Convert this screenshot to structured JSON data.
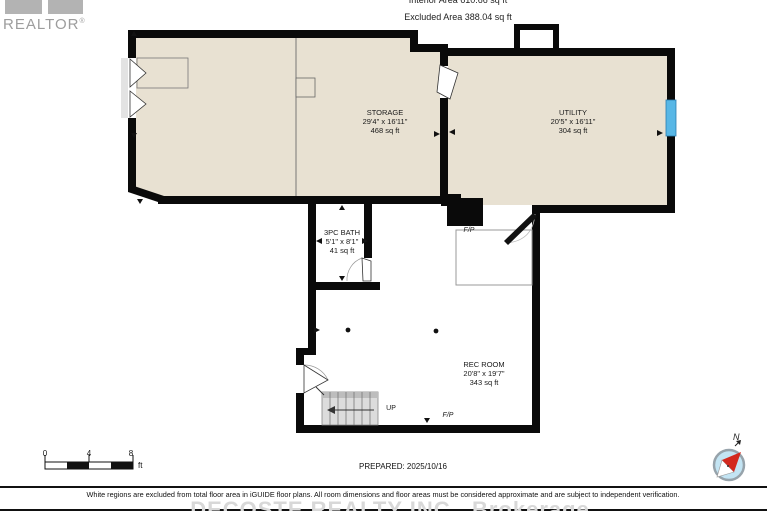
{
  "header": {
    "interior_area": "Interior Area 610.66 sq ft",
    "excluded_area": "Excluded Area 388.04 sq ft"
  },
  "logo": {
    "text": "REALTOR",
    "registered": "®"
  },
  "rooms": [
    {
      "name": "STORAGE",
      "dimensions": "29'4\" x 16'11\"",
      "area": "468 sq ft"
    },
    {
      "name": "UTILITY",
      "dimensions": "20'5\" x 16'11\"",
      "area": "304 sq ft"
    },
    {
      "name": "3PC BATH",
      "dimensions": "5'1\" x 8'1\"",
      "area": "41 sq ft"
    },
    {
      "name": "REC ROOM",
      "dimensions": "20'8\" x 19'7\"",
      "area": "343 sq ft"
    }
  ],
  "labels": {
    "fireplace": "F/P",
    "up": "UP"
  },
  "scale_bar": {
    "ticks": [
      "0",
      "4",
      "8"
    ],
    "unit": "ft"
  },
  "compass": {
    "north": "N"
  },
  "footer": {
    "prepared": "PREPARED: 2025/10/16",
    "disclaimer": "White regions are excluded from total floor area in iGUIDE floor plans. All room dimensions and floor areas must be considered approximate and are subject to independent verification.",
    "watermark": "DECOSTE REALTY INC., Brokerage"
  },
  "colors": {
    "room_fill": "#e8e1d2",
    "wall": "#0a0a0a",
    "window": "#58b7e6",
    "stairs": "#dcdcdc",
    "watermark_gray": "#d8d8d8",
    "logo_gray": "#aaaaaa",
    "compass_fill": "#c3e4f3",
    "compass_needle": "#d3291e"
  }
}
